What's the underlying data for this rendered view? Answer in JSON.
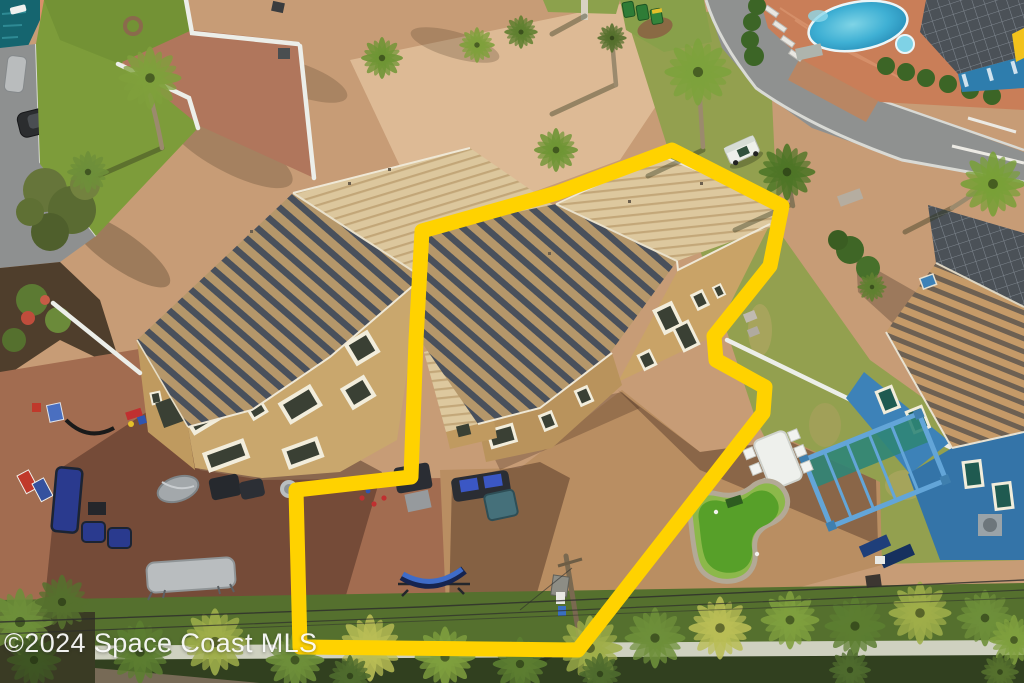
{
  "photo": {
    "type": "aerial-drone-photograph",
    "subject": "Rear aerial view of a two-story tan duplex townhome with barrel-tile roof; a thick yellow outline marks the boundary of the right-hand unit and its paver yard",
    "width_px": 1024,
    "height_px": 683
  },
  "watermark": {
    "text": "©2024 Space Coast MLS"
  },
  "boundary": {
    "style": "hand-drawn property outline",
    "color": "#FFD200"
  },
  "colors": {
    "boundary_yellow": "#FFD200",
    "roof_light_tan": "#DCC79D",
    "roof_shadow_slate": "#49505B",
    "stucco_tan": "#C9A76D",
    "paver_courtyard": "#C79C76",
    "paver_patio_red": "#A26C50",
    "asphalt_road": "#8F9190",
    "lawn_green": "#7D9C3A",
    "right_lawn_olive": "#93A04F",
    "pool_water": "#2E9FC8",
    "pool_deck_terracotta": "#C97E58",
    "pavilion_roof": "#4B5157",
    "blue_house": "#3D82B8",
    "pergola_blue": "#63A5D8",
    "putting_green": "#57A029",
    "white_fence": "#ECEEE9",
    "privacy_wall": "#CFD1C0",
    "vegetation_dark": "#55702E",
    "watermark_white": "#FFFFFF"
  },
  "scene_objects": [
    "duplex-left-unit",
    "duplex-right-unit",
    "property-boundary-outline",
    "community-pool",
    "pool-pavilion",
    "street-and-road",
    "parked-cars",
    "trash-bins",
    "royal-palms",
    "white-vinyl-fences",
    "left-patio-furniture",
    "blue-hammock",
    "trampoline",
    "blue-house",
    "blue-pergola",
    "putting-green",
    "outdoor-dining-set",
    "utility-pole",
    "power-lines",
    "privacy-wall",
    "tropical-vegetation"
  ]
}
